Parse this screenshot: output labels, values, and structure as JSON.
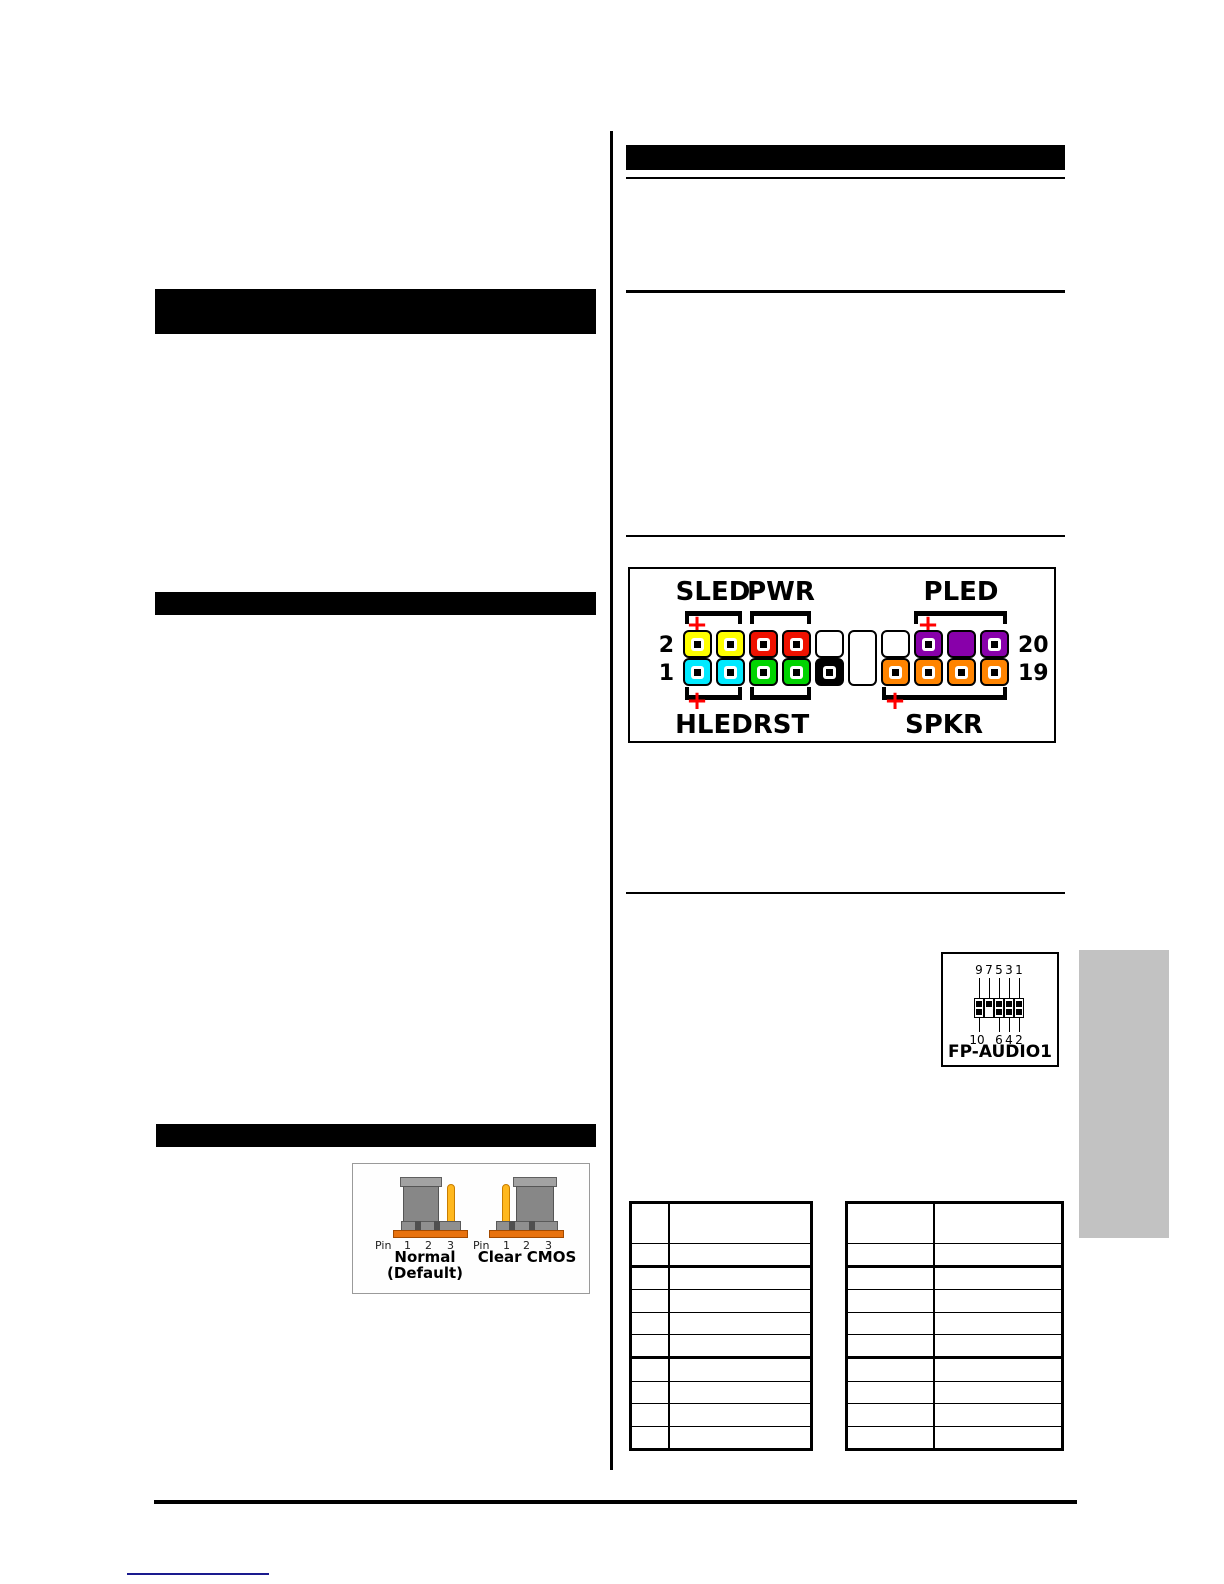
{
  "front_panel": {
    "labels": {
      "sled": "SLED",
      "pwr": "PWR",
      "pled": "PLED",
      "hled": "HLED",
      "rst": "RST",
      "spkr": "SPKR"
    },
    "row_numbers": {
      "top_left": "2",
      "bottom_left": "1",
      "top_right": "20",
      "bottom_right": "19"
    },
    "plus_sign": "+",
    "polarity_color": "#ff0000",
    "columns": [
      {
        "top": {
          "color": "#ffff00",
          "pin": true
        },
        "bottom": {
          "color": "#00eaff",
          "pin": true
        }
      },
      {
        "top": {
          "color": "#ffff00",
          "pin": true
        },
        "bottom": {
          "color": "#00eaff",
          "pin": true
        }
      },
      {
        "top": {
          "color": "#ee1100",
          "pin": true
        },
        "bottom": {
          "color": "#00d400",
          "pin": true
        }
      },
      {
        "top": {
          "color": "#ee1100",
          "pin": true
        },
        "bottom": {
          "color": "#00d400",
          "pin": true
        }
      },
      {
        "top": {
          "color": "#ffffff",
          "pin": false
        },
        "bottom": {
          "color": "#000000",
          "pin": true
        }
      },
      {
        "gap": true
      },
      {
        "top": {
          "color": "#ffffff",
          "pin": false
        },
        "bottom": {
          "color": "#ff8400",
          "pin": true
        }
      },
      {
        "top": {
          "color": "#8800aa",
          "pin": true
        },
        "bottom": {
          "color": "#ff8400",
          "pin": true
        }
      },
      {
        "top": {
          "color": "#8800aa",
          "pin": false
        },
        "bottom": {
          "color": "#ff8400",
          "pin": true
        }
      },
      {
        "top": {
          "color": "#8800aa",
          "pin": true
        },
        "bottom": {
          "color": "#ff8400",
          "pin": true
        }
      }
    ]
  },
  "fp_audio": {
    "label": "FP-AUDIO1",
    "top_labels": [
      "9",
      "7",
      "5",
      "3",
      "1"
    ],
    "bottom_labels": [
      "10",
      "",
      "6",
      "4",
      "2"
    ],
    "columns": [
      {
        "top": true,
        "bottom": true
      },
      {
        "top": true,
        "bottom": false
      },
      {
        "top": true,
        "bottom": true
      },
      {
        "top": true,
        "bottom": true
      },
      {
        "top": true,
        "bottom": true
      }
    ]
  },
  "cmos_figure": {
    "pin_word": "Pin",
    "pin_numbers": [
      "1",
      "2",
      "3"
    ],
    "normal_caption_line1": "Normal",
    "normal_caption_line2": "(Default)",
    "clear_caption": "Clear CMOS",
    "cap_color": "#878787",
    "pin_color": "#ffb81e",
    "base_color": "#e8720e"
  },
  "tables": {
    "left": {
      "col1_width": 36,
      "row_heights": [
        39,
        21,
        21,
        22,
        21,
        21,
        22,
        21,
        22,
        21
      ],
      "thick_after": [
        1,
        5
      ]
    },
    "right": {
      "col1_width": 85,
      "row_heights": [
        39,
        21,
        21,
        22,
        21,
        21,
        22,
        21,
        22,
        21
      ],
      "thick_after": [
        1,
        5
      ]
    }
  },
  "page_marks": {
    "tab_color": "#c2c2c2",
    "link_color": "#1a1a8e"
  }
}
